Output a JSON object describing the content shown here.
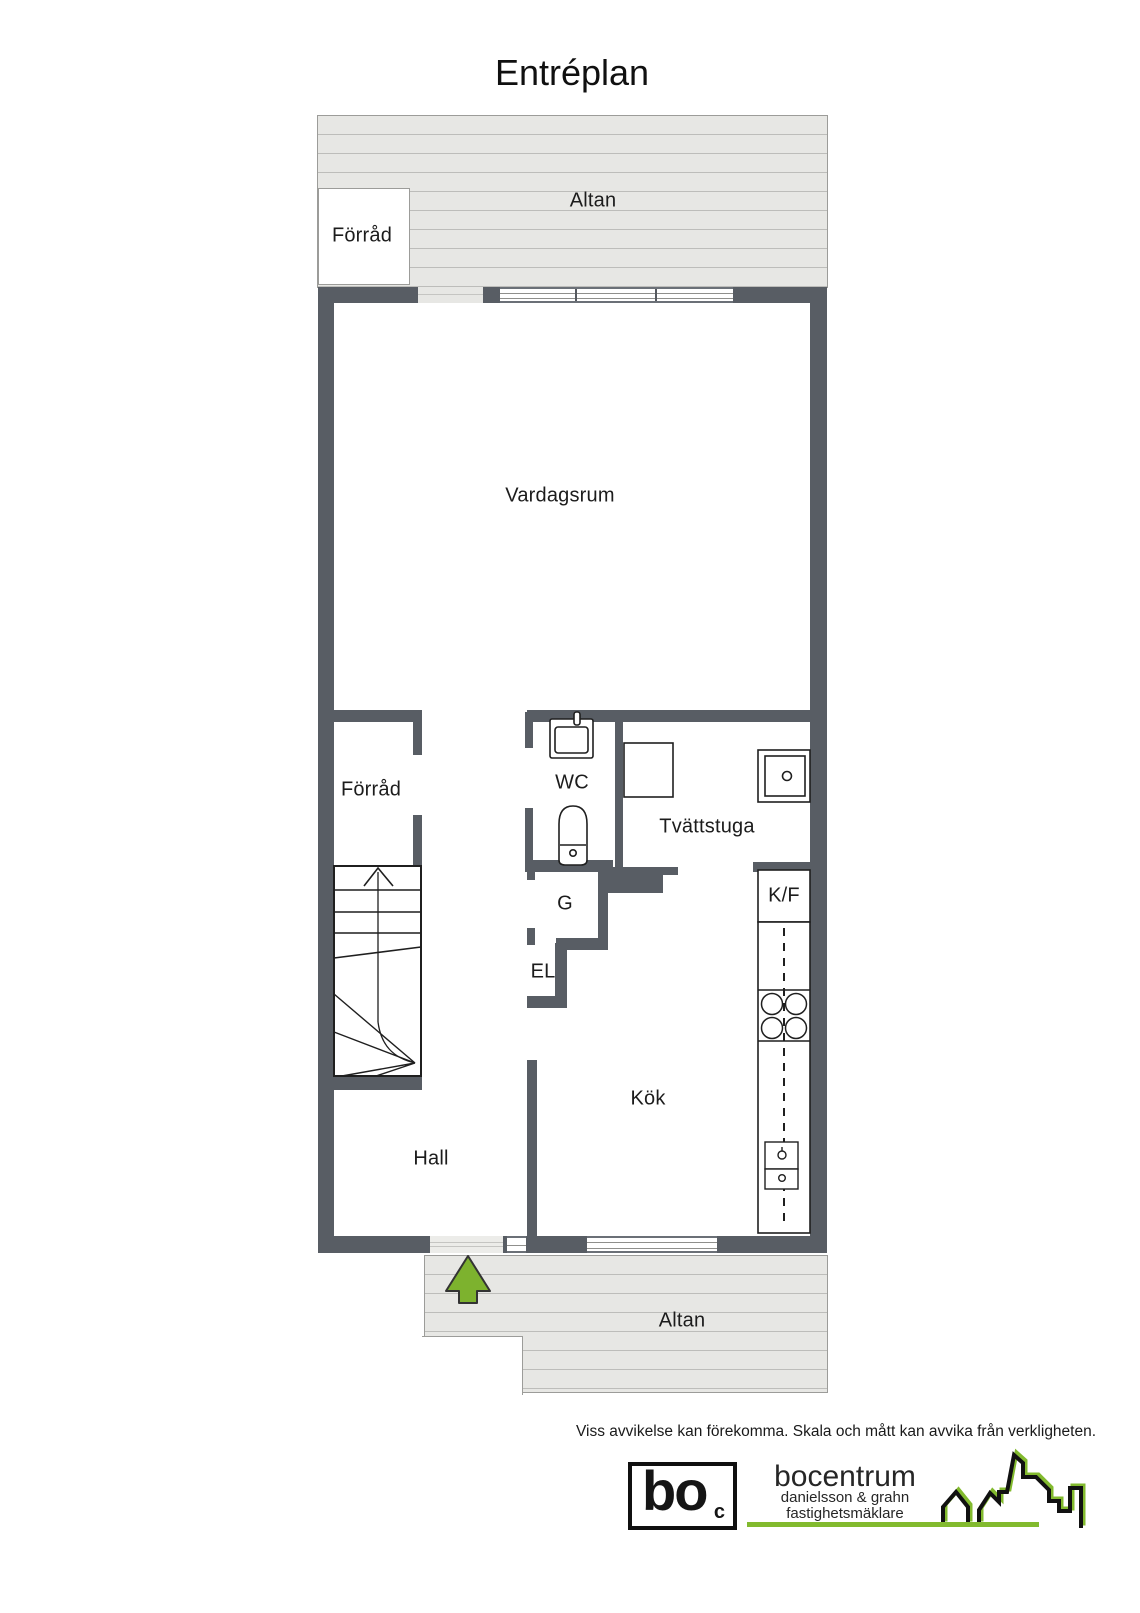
{
  "title": "Entréplan",
  "rooms": {
    "altan_top": "Altan",
    "storage_outdoor": "Förråd",
    "living_room": "Vardagsrum",
    "storage": "Förråd",
    "wc": "WC",
    "laundry": "Tvättstuga",
    "wardrobe": "G",
    "electrical": "EL",
    "fridge_freezer": "K/F",
    "kitchen": "Kök",
    "hall": "Hall",
    "altan_bottom": "Altan"
  },
  "disclaimer": "Viss avvikelse kan förekomma. Skala och mått kan avvika från verkligheten.",
  "logo": {
    "mark": "bo",
    "mark_sub": "c",
    "name": "bocentrum",
    "tagline1": "danielsson & grahn",
    "tagline2": "fastighetsmäklare"
  },
  "colors": {
    "wall": "#585d64",
    "deck": "#e7e7e4",
    "deck_line": "#bdbdba",
    "deck_border": "#9c9c99",
    "arrow_green": "#7db22e",
    "logo_green": "#82ba2e",
    "ink": "#1c1c1c"
  }
}
